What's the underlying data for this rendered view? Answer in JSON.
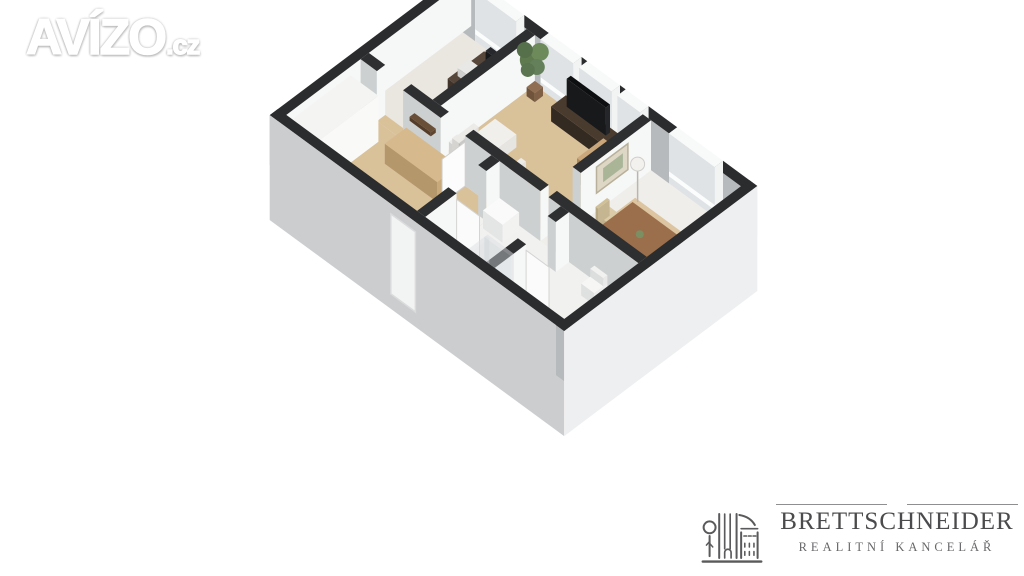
{
  "page": {
    "background": "#ffffff"
  },
  "avizo_logo": {
    "brand": "AVÍZO",
    "tld": ".cz",
    "color": "#ffffff",
    "outline": "#a2a2a2"
  },
  "realty_logo": {
    "name": "BRETTSCHNEIDER",
    "subtitle": "REALITNÍ KANCELÁŘ",
    "color": "#4b4b4d",
    "subtitle_color": "#68686a",
    "icon": "building-tree-icon"
  },
  "floorplan": {
    "style": "3d-isometric",
    "wall_cap_color": "#2e2f31",
    "wall_cap_exterior": "#2b2c2e",
    "wall_face_light": "#f6f7f7",
    "wall_face_shade": "#cdd0d1",
    "wall_face_dark": "#b7babc",
    "exterior_sw": "#cbcdcf",
    "exterior_se": "#eeeff0",
    "exterior_nw": "#d4d5d7",
    "window_pane": "#dfe3e5",
    "window_sill": "#f8f9f9",
    "floor_wood": "#d9c19a",
    "floor_light": "#f0eeea",
    "floor_office": "#eae7e1",
    "floor_bath": "#f1f1ef",
    "slab": "#f4f3f1",
    "furniture_wood": "#c7a97c",
    "furniture_dark": "#4a3b30",
    "tv_black": "#17191b",
    "sofa_white": "#f0efec",
    "plant_green": "#5f7a4e",
    "table_brown": "#9b6f4b"
  }
}
